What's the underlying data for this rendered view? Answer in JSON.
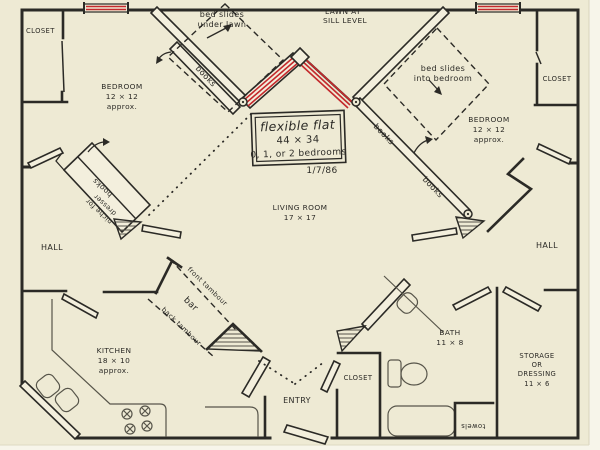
{
  "colors": {
    "paper": "#eeead4",
    "ink": "#2b2a26",
    "track_red": "#c4292c",
    "pencil": "#57554a"
  },
  "title_block": {
    "title": "flexible flat",
    "dimensions": "44 × 34",
    "bedrooms": "0, 1, or 2 bedrooms",
    "date": "1/7/86"
  },
  "labels": {
    "lawn1": "LAWN AT",
    "lawn2": "SILL LEVEL",
    "closet": "CLOSET",
    "bedroom": "BEDROOM",
    "bedroom_size": "12 × 12",
    "approx": "approx.",
    "bed_slides_left1": "bed slides",
    "bed_slides_left2": "under lawn",
    "bed_slides_right1": "bed slides",
    "bed_slides_right2": "into bedroom",
    "books": "books",
    "niche1": "niche for",
    "niche2": "dresser",
    "living1": "LIVING ROOM",
    "living2": "17 × 17",
    "hall": "HALL",
    "kitchen1": "KITCHEN",
    "kitchen2": "18 × 10",
    "bar": "bar",
    "front_tambour": "front tambour",
    "back_tambour": "back tambour",
    "entry": "ENTRY",
    "bath1": "BATH",
    "bath2": "11 × 8",
    "storage1": "STORAGE",
    "storage2": "OR",
    "storage3": "DRESSING",
    "storage4": "11 × 6",
    "towels": "towels"
  }
}
